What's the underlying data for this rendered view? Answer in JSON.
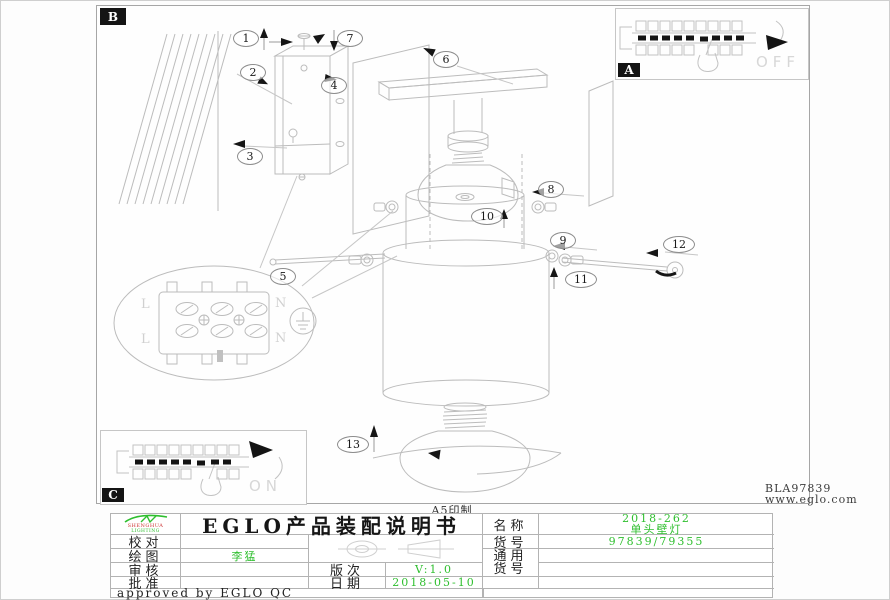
{
  "page": {
    "print_note": "A5印制",
    "drawing_code": "BLA97839",
    "website": "www.eglo.com"
  },
  "insets": {
    "a_label": "A",
    "b_label": "B",
    "c_label": "C",
    "off_word": "OFF",
    "on_word": "ON"
  },
  "callouts": [
    "1",
    "2",
    "3",
    "4",
    "5",
    "6",
    "7",
    "8",
    "9",
    "10",
    "11",
    "12",
    "13"
  ],
  "diagram": {
    "terminal_labels": [
      "L",
      "N",
      "L",
      "N"
    ]
  },
  "title_block": {
    "logo_line1": "SHENGHUA",
    "logo_line2": "LIGHTING",
    "title": "EGLO产品装配说明书",
    "check_label": "校对",
    "check_value": "",
    "draw_label": "绘图",
    "draw_value": "李猛",
    "review_label": "审核",
    "review_value": "",
    "approve_label": "批准",
    "approve_value": "",
    "version_label": "版次",
    "version_value": "V:1.0",
    "date_label": "日期",
    "date_value": "2018-05-10",
    "approved_note": "approved by EGLO QC",
    "name_label": "名称",
    "name_value_line1": "2018-262",
    "name_value_line2": "单头壁灯",
    "item_label": "货号",
    "item_value": "97839/79355",
    "generic_label_line1": "通用",
    "generic_label_line2": "货号"
  },
  "colors": {
    "accent_green": "#2fbf2f",
    "logo_red": "#cc3333",
    "line_gray": "#b9b9b9"
  }
}
